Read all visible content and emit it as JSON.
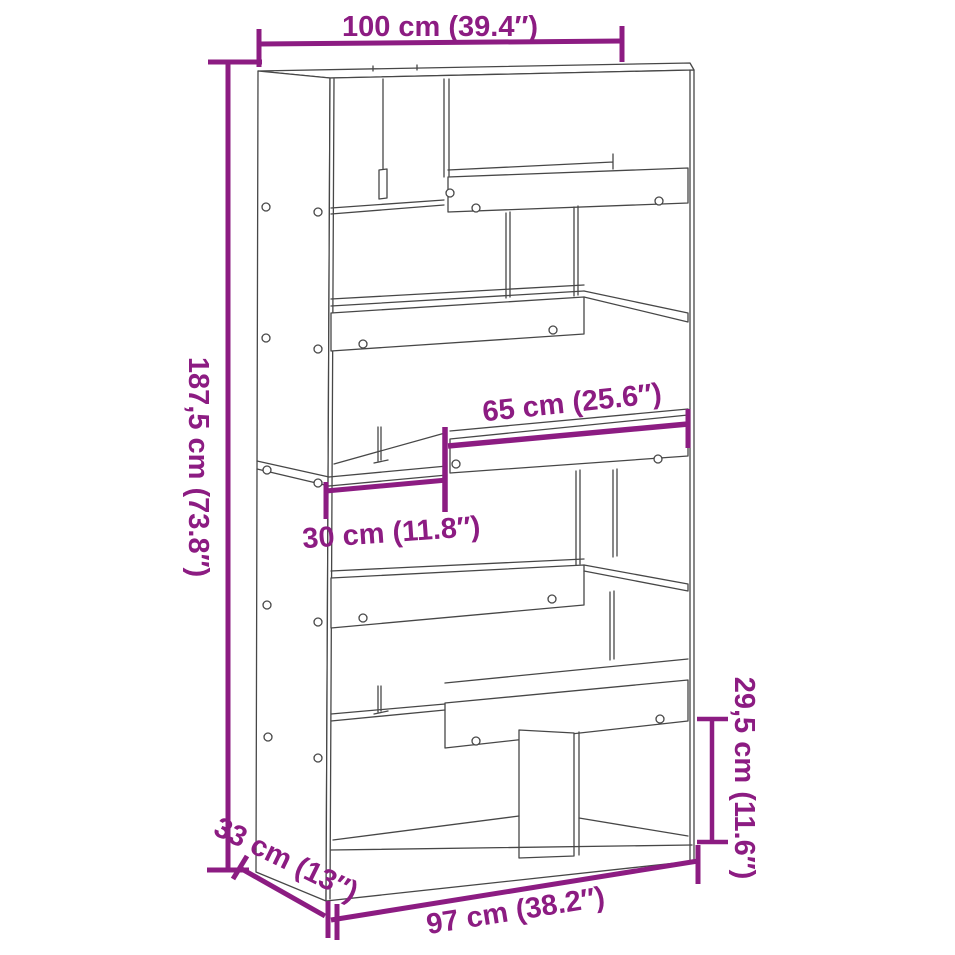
{
  "diagram": {
    "colors": {
      "background": "#ffffff",
      "accent": "#8C1C82",
      "line_art": "#474747"
    },
    "dimensions": {
      "width": {
        "label": "100 cm (39.4″)"
      },
      "height": {
        "label": "187,5 cm (73.8″)"
      },
      "shelf_width": {
        "label": "65 cm (25.6″)"
      },
      "small_shelf_width": {
        "label": "30 cm (11.8″)"
      },
      "compartment_height": {
        "label": "29,5 cm (11.6″)"
      },
      "depth": {
        "label": "33 cm (13″)"
      },
      "base_width": {
        "label": "97 cm (38.2″)"
      }
    }
  }
}
